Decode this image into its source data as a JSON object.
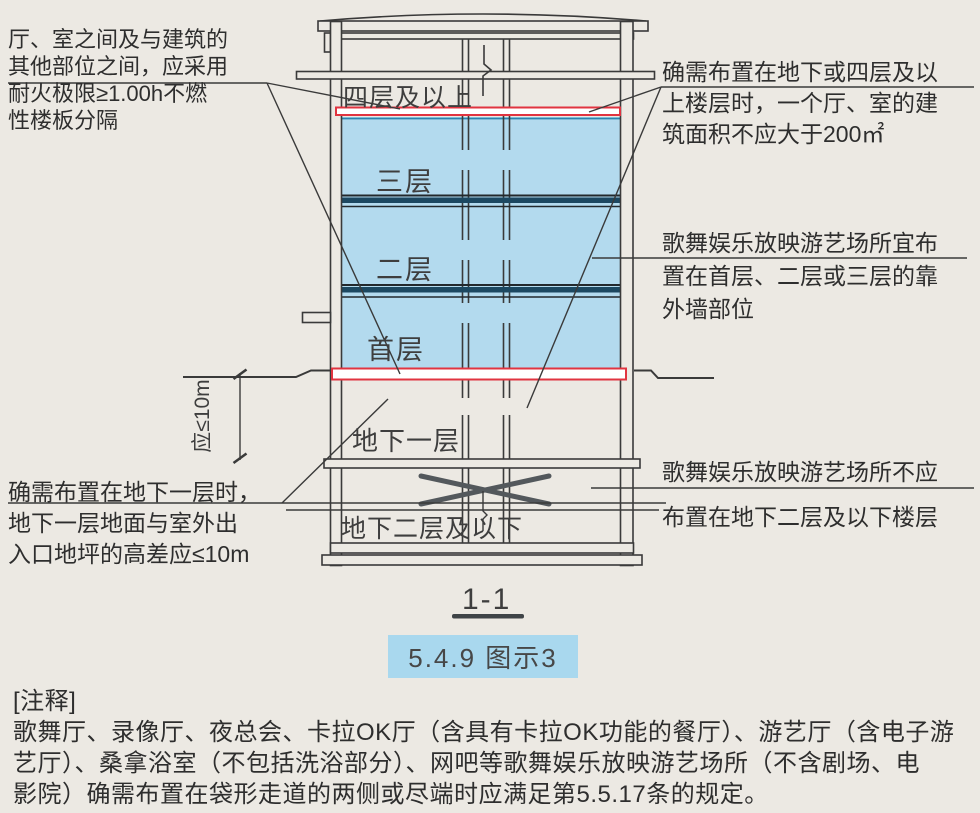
{
  "figure": {
    "section_label": "1-1",
    "badge": "5.4.9 图示3"
  },
  "floors": {
    "f4": "四层及以上",
    "f3": "三层",
    "f2": "二层",
    "f1": "首层",
    "b1": "地下一层",
    "b2": "地下二层及以下"
  },
  "dimension": {
    "label": "应≤10m"
  },
  "annotations": {
    "top_left": {
      "lines": [
        "厅、室之间及与建筑的",
        "其他部位之间，应采用",
        "耐火极限≥1.00h不燃",
        "性楼板分隔"
      ]
    },
    "top_right": {
      "lines": [
        "确需布置在地下或四层及以",
        "上楼层时，一个厅、室的建",
        "筑面积不应大于200㎡"
      ]
    },
    "mid_right": {
      "lines": [
        "歌舞娱乐放映游艺场所宜布",
        "置在首层、二层或三层的靠",
        "外墙部位"
      ]
    },
    "bottom_left": {
      "lines": [
        "确需布置在地下一层时，",
        "地下一层地面与室外出",
        "入口地坪的高差应≤10m"
      ]
    },
    "bottom_right": {
      "lines": [
        "歌舞娱乐放映游艺场所不应",
        "布置在地下二层及以下楼层"
      ]
    }
  },
  "note": {
    "lines": [
      "[注释]",
      "歌舞厅、录像厅、夜总会、卡拉OK厅（含具有卡拉OK功能的餐厅）、游艺厅（含电子游",
      "艺厅）、桑拿浴室（不包括洗浴部分）、网吧等歌舞娱乐放映游艺场所（不含剧场、电",
      "影院）确需布置在袋形走道的两侧或尽端时应满足第5.5.17条的规定。"
    ]
  },
  "colors": {
    "highlight_blue": "#b3daee",
    "slab_dark_blue": "#1c4861",
    "slab_red": "#e13440",
    "badge_blue": "#a9d8ee"
  }
}
